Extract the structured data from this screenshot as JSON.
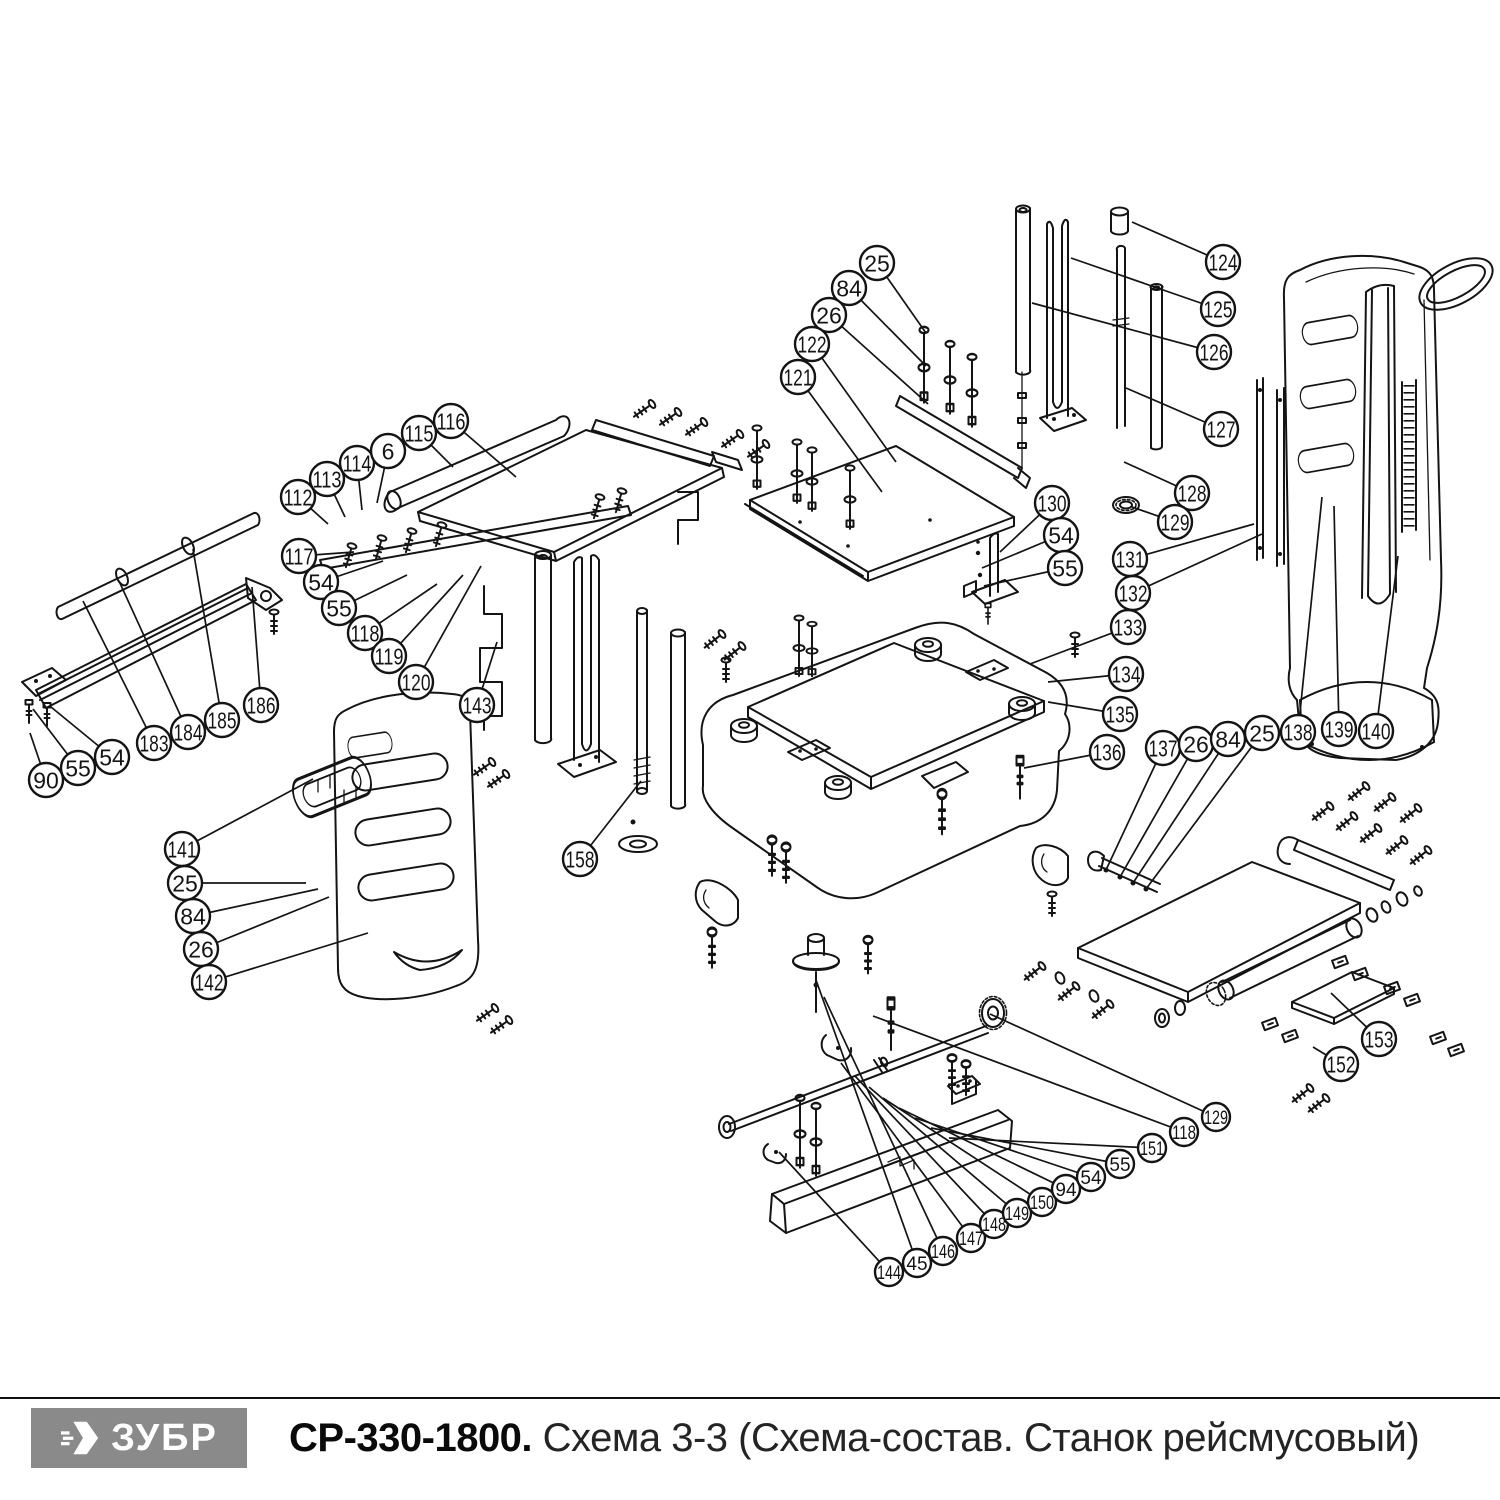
{
  "footer": {
    "brand": "ЗУБР",
    "model": "СР-330-1800.",
    "schema_title": "Схема 3-3 (Схема-состав. Станок рейсмусовый)"
  },
  "colors": {
    "line": "#141414",
    "logo_bg": "#8a8a8a",
    "logo_text": "#ffffff",
    "background": "#ffffff"
  },
  "balloon_radius_default": 17,
  "balloons": [
    {
      "label": "25",
      "x": 877,
      "y": 263,
      "tx": 926,
      "ty": 333
    },
    {
      "label": "84",
      "x": 849,
      "y": 288,
      "tx": 926,
      "ty": 366
    },
    {
      "label": "26",
      "x": 829,
      "y": 315,
      "tx": 928,
      "ty": 404
    },
    {
      "label": "122",
      "x": 812,
      "y": 344,
      "tx": 896,
      "ty": 462
    },
    {
      "label": "121",
      "x": 798,
      "y": 377,
      "tx": 882,
      "ty": 492
    },
    {
      "label": "124",
      "x": 1223,
      "y": 262,
      "tx": 1132,
      "ty": 222
    },
    {
      "label": "125",
      "x": 1218,
      "y": 309,
      "tx": 1071,
      "ty": 258
    },
    {
      "label": "126",
      "x": 1214,
      "y": 352,
      "tx": 1032,
      "ty": 303
    },
    {
      "label": "127",
      "x": 1221,
      "y": 429,
      "tx": 1126,
      "ty": 388
    },
    {
      "label": "128",
      "x": 1192,
      "y": 493,
      "tx": 1124,
      "ty": 462
    },
    {
      "label": "129",
      "x": 1175,
      "y": 522,
      "tx": 1132,
      "ty": 507
    },
    {
      "label": "130",
      "x": 1052,
      "y": 503,
      "tx": 1000,
      "ty": 552
    },
    {
      "label": "54",
      "x": 1061,
      "y": 535,
      "tx": 982,
      "ty": 568
    },
    {
      "label": "55",
      "x": 1065,
      "y": 568,
      "tx": 984,
      "ty": 586
    },
    {
      "label": "131",
      "x": 1130,
      "y": 559,
      "tx": 1254,
      "ty": 524
    },
    {
      "label": "132",
      "x": 1133,
      "y": 593,
      "tx": 1262,
      "ty": 534
    },
    {
      "label": "133",
      "x": 1128,
      "y": 627,
      "tx": 1030,
      "ty": 664
    },
    {
      "label": "134",
      "x": 1126,
      "y": 674,
      "tx": 1048,
      "ty": 682
    },
    {
      "label": "135",
      "x": 1120,
      "y": 714,
      "tx": 1048,
      "ty": 702
    },
    {
      "label": "136",
      "x": 1107,
      "y": 752,
      "tx": 1024,
      "ty": 768
    },
    {
      "label": "137",
      "x": 1163,
      "y": 748,
      "tx": 1106,
      "ty": 870
    },
    {
      "label": "26",
      "x": 1196,
      "y": 744,
      "tx": 1120,
      "ty": 877
    },
    {
      "label": "84",
      "x": 1228,
      "y": 739,
      "tx": 1133,
      "ty": 883
    },
    {
      "label": "25",
      "x": 1262,
      "y": 733,
      "tx": 1146,
      "ty": 889
    },
    {
      "label": "138",
      "x": 1298,
      "y": 732,
      "tx": 1322,
      "ty": 497
    },
    {
      "label": "139",
      "x": 1339,
      "y": 729,
      "tx": 1334,
      "ty": 506
    },
    {
      "label": "140",
      "x": 1376,
      "y": 731,
      "tx": 1398,
      "ty": 556
    },
    {
      "label": "141",
      "x": 182,
      "y": 849,
      "tx": 313,
      "ty": 779
    },
    {
      "label": "25",
      "x": 185,
      "y": 883,
      "tx": 306,
      "ty": 883
    },
    {
      "label": "84",
      "x": 193,
      "y": 916,
      "tx": 318,
      "ty": 889
    },
    {
      "label": "26",
      "x": 201,
      "y": 949,
      "tx": 329,
      "ty": 897
    },
    {
      "label": "142",
      "x": 209,
      "y": 982,
      "tx": 368,
      "ty": 933
    },
    {
      "label": "143",
      "x": 477,
      "y": 705,
      "tx": 497,
      "ty": 642
    },
    {
      "label": "158",
      "x": 580,
      "y": 859,
      "tx": 641,
      "ty": 781
    },
    {
      "label": "90",
      "x": 46,
      "y": 780,
      "tx": 30,
      "ty": 733
    },
    {
      "label": "55",
      "x": 78,
      "y": 768,
      "tx": 33,
      "ty": 709
    },
    {
      "label": "54",
      "x": 112,
      "y": 757,
      "tx": 51,
      "ty": 707
    },
    {
      "label": "183",
      "x": 154,
      "y": 743,
      "tx": 83,
      "ty": 601
    },
    {
      "label": "184",
      "x": 188,
      "y": 732,
      "tx": 119,
      "ty": 581
    },
    {
      "label": "185",
      "x": 222,
      "y": 720,
      "tx": 193,
      "ty": 549
    },
    {
      "label": "186",
      "x": 261,
      "y": 705,
      "tx": 252,
      "ty": 587
    },
    {
      "label": "112",
      "x": 298,
      "y": 497,
      "tx": 328,
      "ty": 524
    },
    {
      "label": "113",
      "x": 327,
      "y": 479,
      "tx": 345,
      "ty": 517
    },
    {
      "label": "114",
      "x": 357,
      "y": 463,
      "tx": 362,
      "ty": 510
    },
    {
      "label": "6",
      "x": 388,
      "y": 451,
      "tx": 377,
      "ty": 503
    },
    {
      "label": "115",
      "x": 419,
      "y": 433,
      "tx": 453,
      "ty": 467
    },
    {
      "label": "116",
      "x": 451,
      "y": 421,
      "tx": 516,
      "ty": 477
    },
    {
      "label": "117",
      "x": 299,
      "y": 556,
      "tx": 354,
      "ty": 552
    },
    {
      "label": "54",
      "x": 321,
      "y": 582,
      "tx": 383,
      "ty": 561
    },
    {
      "label": "55",
      "x": 339,
      "y": 608,
      "tx": 407,
      "ty": 575
    },
    {
      "label": "118",
      "x": 365,
      "y": 633,
      "tx": 437,
      "ty": 584
    },
    {
      "label": "119",
      "x": 389,
      "y": 656,
      "tx": 463,
      "ty": 575
    },
    {
      "label": "120",
      "x": 416,
      "y": 682,
      "tx": 481,
      "ty": 566
    },
    {
      "label": "144",
      "x": 889,
      "y": 1272,
      "tx": 779,
      "ty": 1152,
      "r": 14
    },
    {
      "label": "45",
      "x": 917,
      "y": 1263,
      "tx": 816,
      "ty": 980,
      "r": 14
    },
    {
      "label": "146",
      "x": 943,
      "y": 1251,
      "tx": 824,
      "ty": 997,
      "r": 14
    },
    {
      "label": "147",
      "x": 971,
      "y": 1238,
      "tx": 841,
      "ty": 1063,
      "r": 14
    },
    {
      "label": "148",
      "x": 994,
      "y": 1224,
      "tx": 855,
      "ty": 1076,
      "r": 14
    },
    {
      "label": "149",
      "x": 1017,
      "y": 1213,
      "tx": 869,
      "ty": 1087,
      "r": 14
    },
    {
      "label": "150",
      "x": 1042,
      "y": 1202,
      "tx": 883,
      "ty": 1098,
      "r": 14
    },
    {
      "label": "94",
      "x": 1066,
      "y": 1189,
      "tx": 899,
      "ty": 1108,
      "r": 14
    },
    {
      "label": "54",
      "x": 1091,
      "y": 1177,
      "tx": 915,
      "ty": 1118,
      "r": 14
    },
    {
      "label": "55",
      "x": 1120,
      "y": 1164,
      "tx": 931,
      "ty": 1128,
      "r": 14
    },
    {
      "label": "151",
      "x": 1152,
      "y": 1148,
      "tx": 949,
      "ty": 1138,
      "r": 14
    },
    {
      "label": "118",
      "x": 1184,
      "y": 1132,
      "tx": 873,
      "ty": 1016,
      "r": 14
    },
    {
      "label": "129",
      "x": 1216,
      "y": 1117,
      "tx": 990,
      "ty": 1014,
      "r": 14
    },
    {
      "label": "152",
      "x": 1341,
      "y": 1064,
      "tx": 1313,
      "ty": 1047
    },
    {
      "label": "153",
      "x": 1379,
      "y": 1039,
      "tx": 1331,
      "ty": 993
    }
  ]
}
